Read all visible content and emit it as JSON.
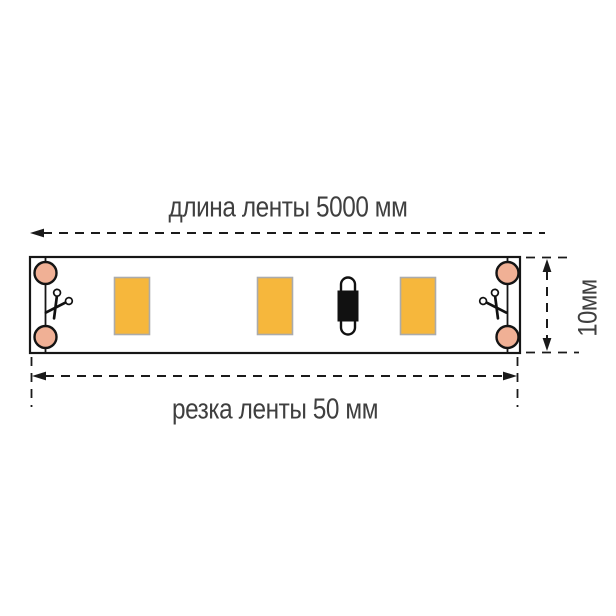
{
  "labels": {
    "top": "длина ленты 5000 мм",
    "bottom": "резка ленты 50 мм",
    "side": "10мм"
  },
  "dimensions": {
    "tape_length_mm": 5000,
    "cut_step_mm": 50,
    "tape_width_mm": 10
  },
  "strip": {
    "led_chip_count": 3,
    "solder_pad_count": 4,
    "component": "resistor",
    "cut_marks": 2
  },
  "icons": {
    "left_cut": "scissors-icon",
    "right_cut": "scissors-icon"
  },
  "colors": {
    "pad": "#F0B095",
    "chip": "#F6B73C",
    "chip_border": "#ABABAB",
    "line": "#1a1a1a",
    "text": "#3f3f3f",
    "background": "#ffffff"
  }
}
